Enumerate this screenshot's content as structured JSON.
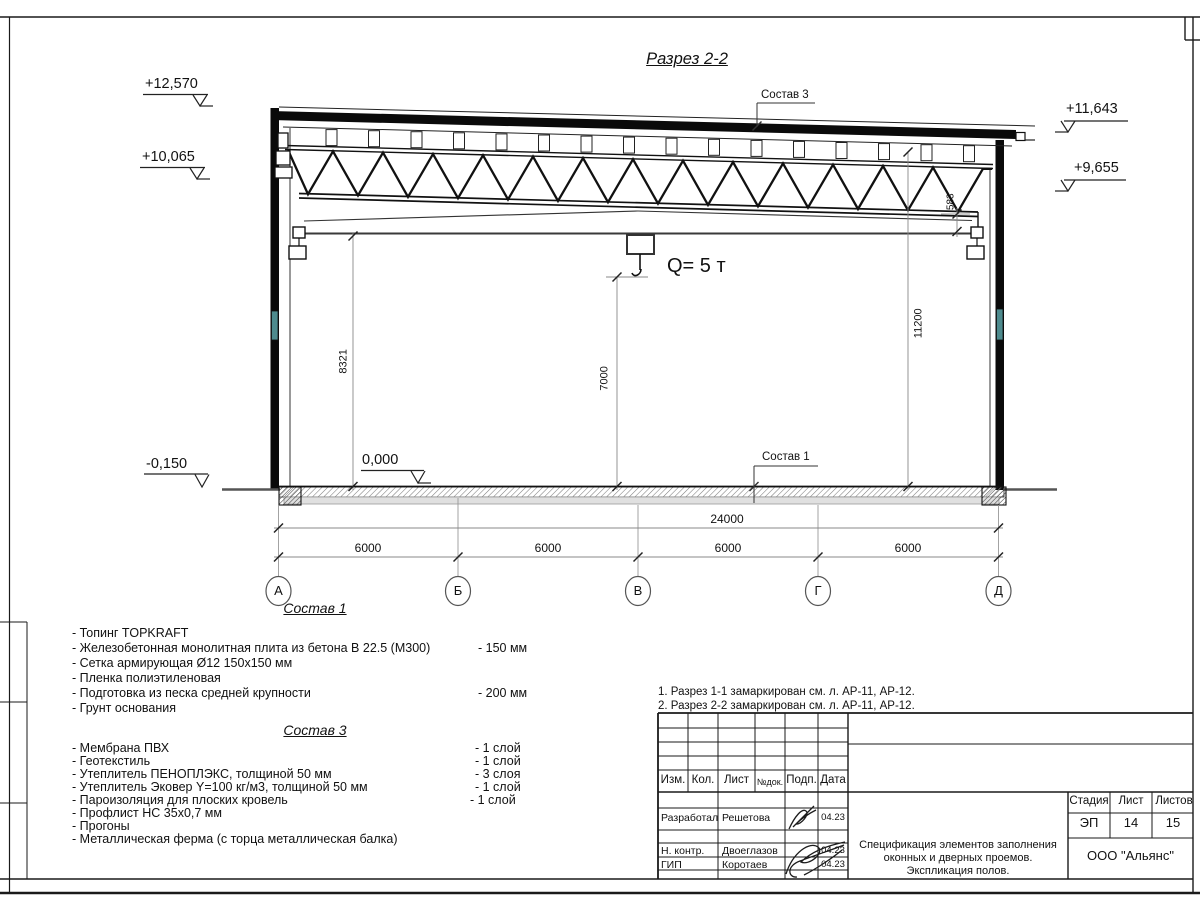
{
  "section": {
    "title": "Разрез 2-2",
    "crane_label": "Q= 5 т",
    "elevations": {
      "left_top": "+12,570",
      "left_mid": "+10,065",
      "right_top": "+11,643",
      "right_mid": "+9,655",
      "floor": "0,000",
      "ground": "-0,150"
    },
    "callouts": {
      "roof": "Состав 3",
      "floor": "Состав 1"
    },
    "dims": {
      "total": "24000",
      "bays": [
        "6000",
        "6000",
        "6000",
        "6000"
      ],
      "left_height": "8321",
      "mid_height": "7000",
      "right_height": "11200",
      "truss_end": "583"
    },
    "axes": [
      "А",
      "Б",
      "В",
      "Г",
      "Д"
    ]
  },
  "floor_spec": {
    "heading": "Состав 1",
    "items": [
      {
        "text": "- Топинг TOPKRAFT",
        "value": ""
      },
      {
        "text": "- Железобетонная  монолитная плита из бетона  В 22.5 (М300)",
        "value": "- 150 мм"
      },
      {
        "text": "- Сетка армирующая Ø12 150х150 мм",
        "value": ""
      },
      {
        "text": "- Пленка полиэтиленовая",
        "value": ""
      },
      {
        "text": "- Подготовка из песка средней  крупности",
        "value": "- 200 мм"
      },
      {
        "text": "- Грунт основания",
        "value": ""
      }
    ]
  },
  "roof_spec": {
    "heading": "Состав 3",
    "items": [
      {
        "text": "- Мембрана ПВХ",
        "value": "- 1 слой"
      },
      {
        "text": "- Геотекстиль",
        "value": "- 1 слой"
      },
      {
        "text": "- Утеплитель ПЕНОПЛЭКС, толщиной 50 мм",
        "value": "- 3 слоя"
      },
      {
        "text": "- Утеплитель Эковер Y=100 кг/м3, толщиной 50 мм",
        "value": "- 1 слой"
      },
      {
        "text": "- Пароизоляция для плоских кровель",
        "value": "- 1 слой"
      },
      {
        "text": "- Профлист НС 35х0,7 мм",
        "value": ""
      },
      {
        "text": "- Прогоны",
        "value": ""
      },
      {
        "text": "- Металлическая ферма (с торца металлическая балка)",
        "value": ""
      }
    ]
  },
  "notes": {
    "line1": "1. Разрез 1-1 замаркирован см. л. АР-11, АР-12.",
    "line2": "2. Разрез 2-2 замаркирован см. л. АР-11, АР-12."
  },
  "title_block": {
    "columns": [
      "Изм.",
      "Кол.",
      "Лист",
      "№док.",
      "Подп.",
      "Дата"
    ],
    "rows": [
      {
        "role": "Разработал",
        "name": "Решетова",
        "date": "04.23"
      },
      {
        "role": "Н. контр.",
        "name": "Двоеглазов",
        "date": "04.23"
      },
      {
        "role": "ГИП",
        "name": "Коротаев",
        "date": "04.23"
      }
    ],
    "stage_label": "Стадия",
    "sheet_label": "Лист",
    "sheets_label": "Листов",
    "stage": "ЭП",
    "sheet": "14",
    "sheets": "15",
    "doc_title_lines": [
      "Спецификация элементов заполнения",
      "оконных и дверных проемов.",
      "Экспликация полов."
    ],
    "company": "ООО \"Альянс\""
  }
}
